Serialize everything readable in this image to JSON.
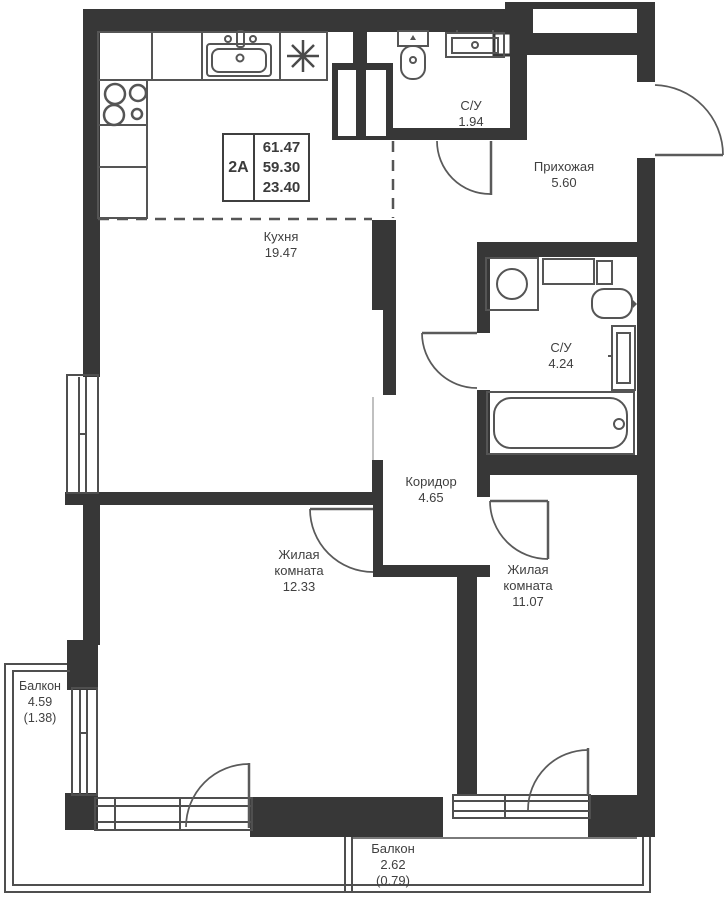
{
  "plan": {
    "info_box": {
      "apartment_type": "2А",
      "total_area": "61.47",
      "living_area": "59.30",
      "kitchen_area": "23.40"
    },
    "rooms": {
      "kitchen": {
        "name": "Кухня",
        "area": "19.47"
      },
      "bathroom_small": {
        "name": "С/У",
        "area": "1.94"
      },
      "hallway": {
        "name": "Прихожая",
        "area": "5.60"
      },
      "bathroom_large": {
        "name": "С/У",
        "area": "4.24"
      },
      "corridor": {
        "name": "Коридор",
        "area": "4.65"
      },
      "living_room_1": {
        "name_line1": "Жилая",
        "name_line2": "комната",
        "area": "12.33"
      },
      "living_room_2": {
        "name_line1": "Жилая",
        "name_line2": "комната",
        "area": "11.07"
      },
      "balcony_left": {
        "name": "Балкон",
        "area": "4.59",
        "reduced_area": "(1.38)"
      },
      "balcony_bottom": {
        "name": "Балкон",
        "area": "2.62",
        "reduced_area": "(0.79)"
      }
    },
    "colors": {
      "wall": "#373737",
      "outline": "#4f4f4f",
      "fixture": "#555555",
      "label": "#404040",
      "background": "#ffffff"
    }
  }
}
